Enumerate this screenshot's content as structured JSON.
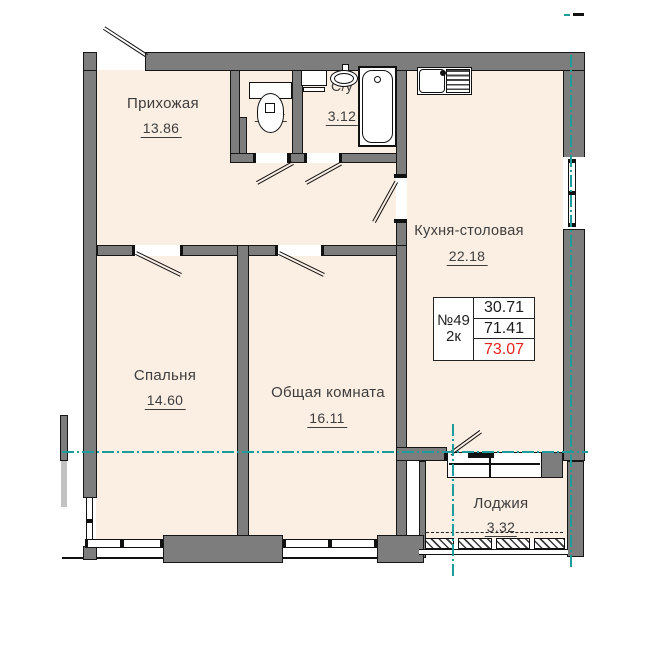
{
  "rooms": [
    {
      "id": "hallway",
      "name": "Прихожая",
      "area": "13.86"
    },
    {
      "id": "wc-small",
      "name": "С/у",
      "area": "1.54"
    },
    {
      "id": "bathroom",
      "name": "С/у",
      "area": "3.12"
    },
    {
      "id": "kitchen-dining",
      "name": "Кухня-столовая",
      "area": "22.18"
    },
    {
      "id": "bedroom",
      "name": "Спальня",
      "area": "14.60"
    },
    {
      "id": "living-room",
      "name": "Общая комната",
      "area": "16.11"
    },
    {
      "id": "loggia",
      "name": "Лоджия",
      "area": "3.32"
    }
  ],
  "info_table": {
    "apartment_number": "№49",
    "apartment_type": "2к",
    "living_area": "30.71",
    "area_without_loggia": "71.41",
    "total_area": "73.07"
  },
  "colors": {
    "wall_gray": "#7d7d7d",
    "room_fill": "#fbeee3",
    "axis_teal": "#1d9c9c",
    "total_area_red": "#e8231e",
    "label_text": "#3d3d3d"
  },
  "fixtures": [
    "toilet",
    "washbasin",
    "washing-machine",
    "bathtub",
    "kitchen-sink"
  ]
}
